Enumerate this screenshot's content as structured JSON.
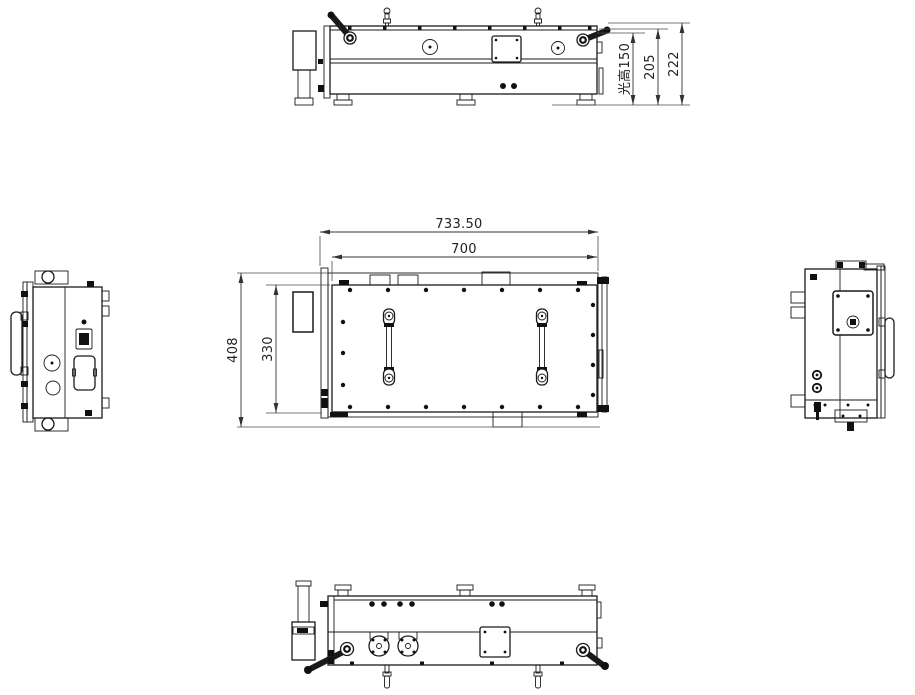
{
  "canvas": {
    "width": 915,
    "height": 695,
    "background": "#ffffff"
  },
  "colors": {
    "object_line": "#1a1a1a",
    "dimension_line": "#4a4a4a",
    "dimension_text": "#222222",
    "dark_fill": "#111111"
  },
  "dimensions": {
    "plan": {
      "overall_length": "733.50",
      "body_length": "700",
      "overall_width": "408",
      "body_width": "330"
    },
    "front": {
      "optical_height_label": "光高150",
      "body_height": "205",
      "overall_height": "222"
    }
  }
}
